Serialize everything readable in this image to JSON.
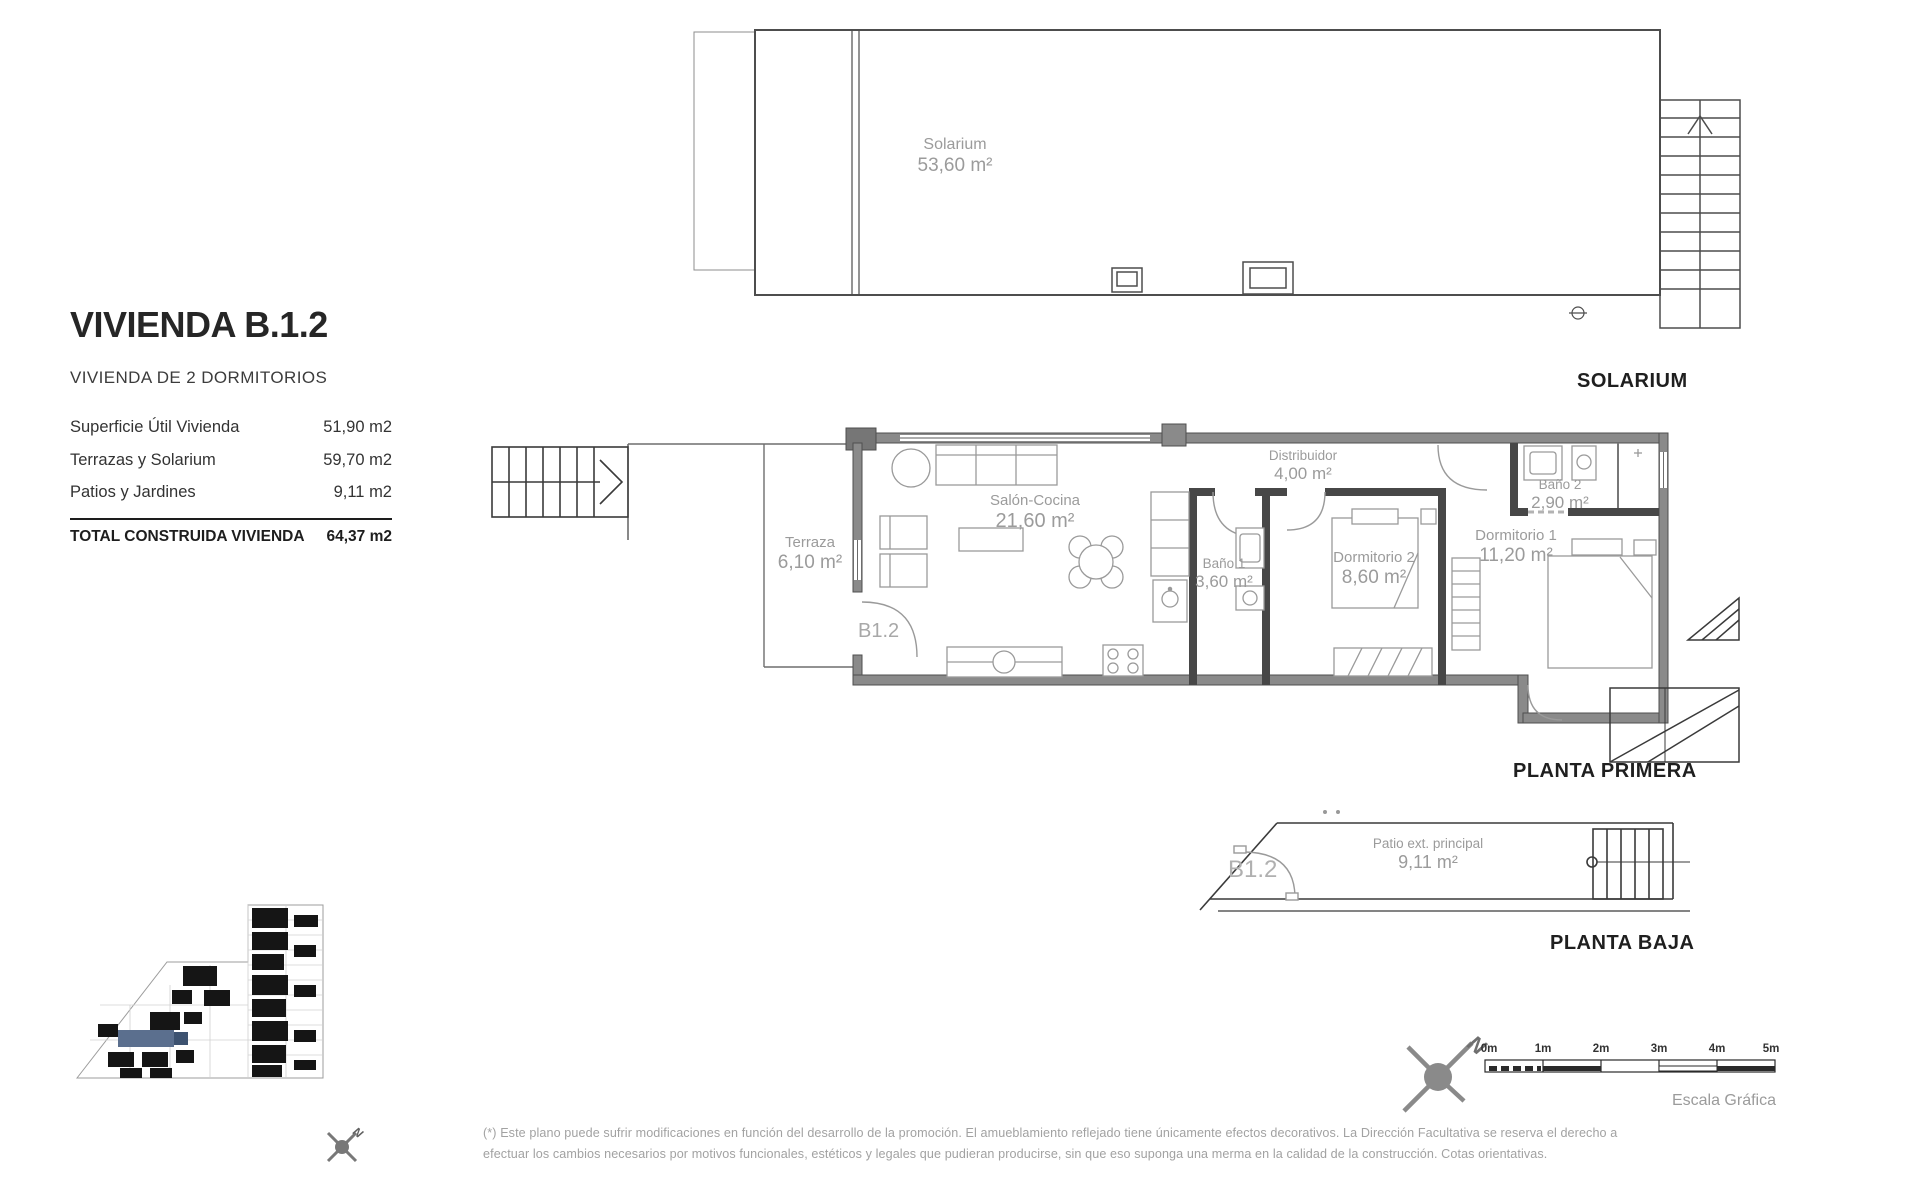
{
  "info_panel": {
    "title": "VIVIENDA B.1.2",
    "subtitle": "VIVIENDA DE 2 DORMITORIOS",
    "rows": [
      {
        "label": "Superficie Útil Vivienda",
        "value": "51,90 m2"
      },
      {
        "label": "Terrazas y Solarium",
        "value": "59,70 m2"
      },
      {
        "label": "Patios y Jardines",
        "value": "9,11 m2"
      }
    ],
    "total_label": "TOTAL CONSTRUIDA VIVIENDA",
    "total_value": "64,37 m2"
  },
  "solarium_plan": {
    "caption": "SOLARIUM",
    "room": {
      "name": "Solarium",
      "area": "53,60 m²"
    }
  },
  "first_floor": {
    "caption": "PLANTA PRIMERA",
    "unit_label": "B1.2",
    "rooms": {
      "terraza": {
        "name": "Terraza",
        "area": "6,10 m²"
      },
      "salon": {
        "name": "Salón-Cocina",
        "area": "21,60 m²"
      },
      "distribuidor": {
        "name": "Distribuidor",
        "area": "4,00 m²"
      },
      "bano1": {
        "name": "Baño 1",
        "area": "3,60 m²"
      },
      "dormitorio2": {
        "name": "Dormitorio 2",
        "area": "8,60 m²"
      },
      "dormitorio1": {
        "name": "Dormitorio 1",
        "area": "11,20 m²"
      },
      "bano2": {
        "name": "Baño 2",
        "area": "2,90 m²"
      }
    }
  },
  "ground_floor": {
    "caption": "PLANTA BAJA",
    "unit_label": "B1.2",
    "rooms": {
      "patio": {
        "name": "Patio ext. principal",
        "area": "9,11 m²"
      }
    }
  },
  "scale_bar": {
    "ticks": [
      "0m",
      "1m",
      "2m",
      "3m",
      "4m",
      "5m"
    ],
    "caption": "Escala Gráfica"
  },
  "compass": {
    "label": "N"
  },
  "footer": {
    "line1": "(*) Este plano puede sufrir modificaciones en función del desarrollo de la promoción. El amueblamiento reflejado tiene únicamente efectos decorativos. La Dirección Facultativa se reserva el derecho a",
    "line2": "efectuar los cambios necesarios por motivos funcionales, estéticos y legales que pudieran producirse, sin que eso suponga una merma en la calidad de la construcción. Cotas orientativas."
  },
  "colors": {
    "wall_gray": "#8a8a8a",
    "wall_dark": "#474747",
    "label_gray": "#9b9b9b",
    "highlight_blue": "#5b6f8e"
  }
}
